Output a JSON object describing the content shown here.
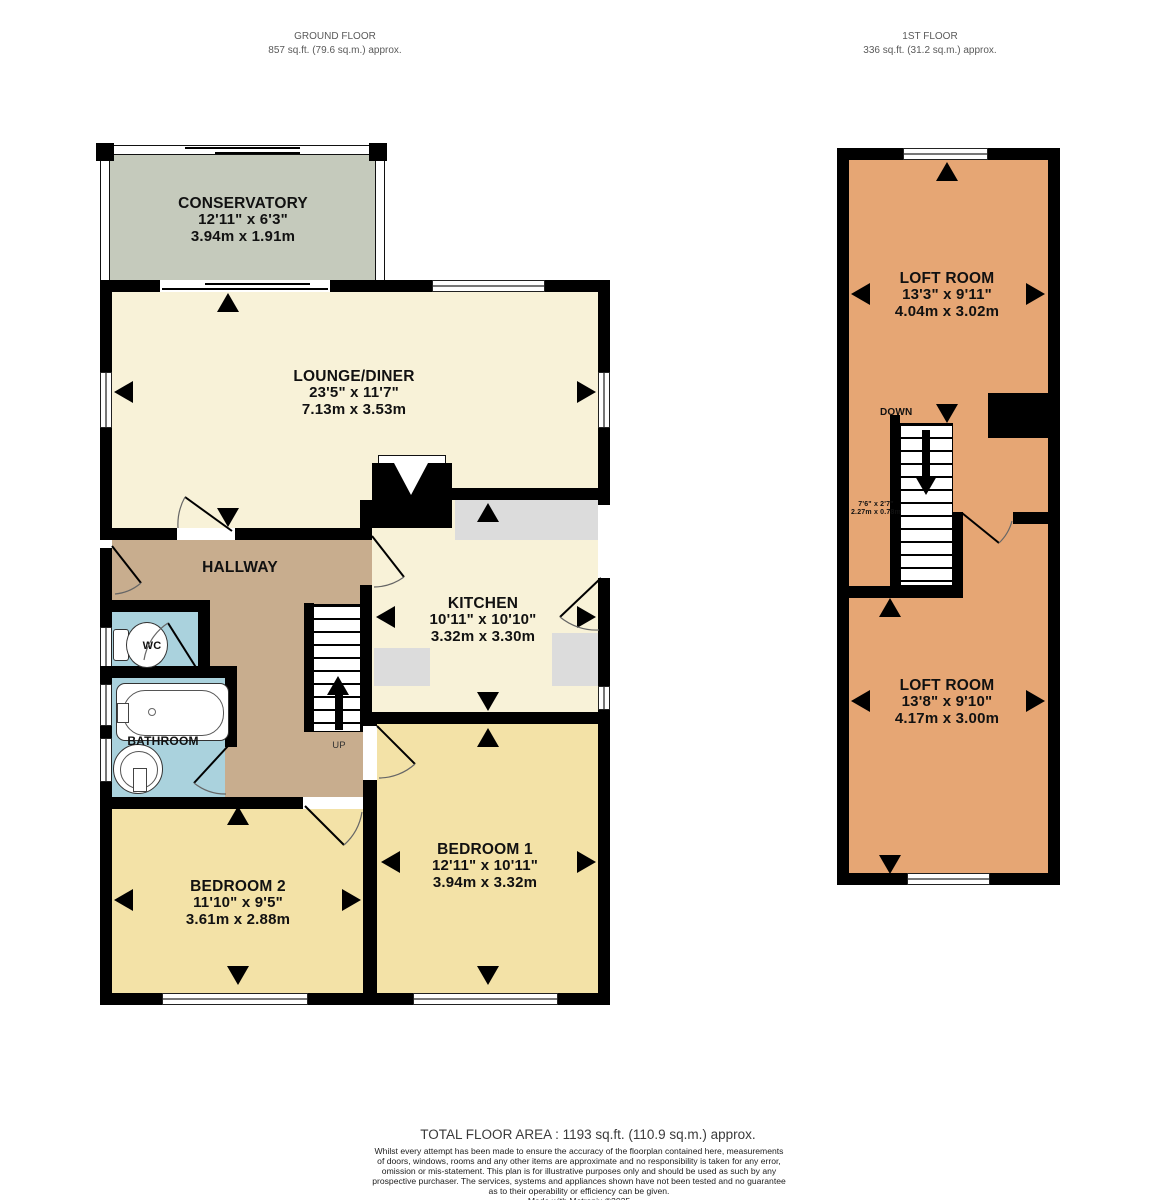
{
  "header": {
    "ground": {
      "title": "GROUND FLOOR",
      "area": "857 sq.ft. (79.6 sq.m.) approx."
    },
    "first": {
      "title": "1ST FLOOR",
      "area": "336 sq.ft. (31.2 sq.m.) approx."
    }
  },
  "rooms": {
    "conservatory": {
      "name": "CONSERVATORY",
      "imperial": "12'11\"  x 6'3\"",
      "metric": "3.94m  x 1.91m"
    },
    "lounge": {
      "name": "LOUNGE/DINER",
      "imperial": "23'5\"  x 11'7\"",
      "metric": "7.13m  x 3.53m"
    },
    "kitchen": {
      "name": "KITCHEN",
      "imperial": "10'11\"  x 10'10\"",
      "metric": "3.32m  x 3.30m"
    },
    "hallway": {
      "name": "HALLWAY"
    },
    "wc": {
      "name": "WC"
    },
    "bathroom": {
      "name": "BATHROOM"
    },
    "bedroom1": {
      "name": "BEDROOM 1",
      "imperial": "12'11\"  x 10'11\"",
      "metric": "3.94m  x 3.32m"
    },
    "bedroom2": {
      "name": "BEDROOM 2",
      "imperial": "11'10\"  x 9'5\"",
      "metric": "3.61m  x 2.88m"
    },
    "loft_top": {
      "name": "LOFT ROOM",
      "imperial": "13'3\"  x 9'11\"",
      "metric": "4.04m  x 3.02m"
    },
    "loft_bottom": {
      "name": "LOFT ROOM",
      "imperial": "13'8\"  x 9'10\"",
      "metric": "4.17m  x 3.00m"
    }
  },
  "stairs": {
    "up_label": "UP",
    "down_label": "DOWN",
    "loft_stair_imperial": "7'6\" x 2'7\"",
    "loft_stair_metric": "2.27m x 0.78m"
  },
  "footer": {
    "total": "TOTAL FLOOR AREA : 1193 sq.ft. (110.9 sq.m.) approx.",
    "disclaimer_lines": [
      "Whilst every attempt has been made to ensure the accuracy of the floorplan contained here, measurements",
      "of doors, windows, rooms and any other items are approximate and no responsibility is taken for any error,",
      "omission or mis-statement. This plan is for illustrative purposes only and should be used as such by any",
      "prospective purchaser. The services, systems and appliances shown have not been tested and no guarantee",
      "as to their operability or efficiency can be given."
    ],
    "credit": "Made with Metropix ©2025"
  },
  "colors": {
    "wall": "#000000",
    "lounge_fill": "#f8f2d8",
    "bedroom_fill": "#f3e2a7",
    "hallway_fill": "#c8ad8e",
    "bath_fill": "#aad2dd",
    "conservatory_fill": "#c5cabc",
    "loft_fill": "#e6a674",
    "counter_fill": "#dcdcdc"
  }
}
